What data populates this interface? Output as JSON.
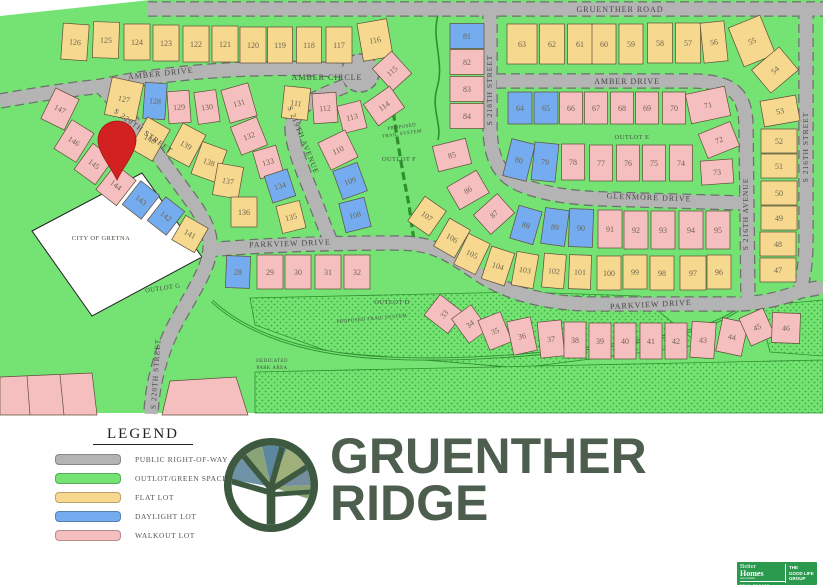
{
  "branding": {
    "title_line1": "GRUENTHER",
    "title_line2": "RIDGE",
    "title_color": "#4d5e4e",
    "logo": "stained-glass-tree-in-circle"
  },
  "bhg_badge": {
    "bg_color": "#2b9a4e",
    "line1": "Better",
    "line2": "Homes",
    "line3": "and Gardens",
    "line4": "REAL ESTATE",
    "right1": "THE",
    "right2": "GOOD LIFE",
    "right3": "GROUP"
  },
  "legend": {
    "title": "LEGEND",
    "items": [
      {
        "label": "PUBLIC RIGHT-OF-WAY",
        "color": "#b4b4b4"
      },
      {
        "label": "OUTLOT/GREEN SPACE",
        "color": "#74e374"
      },
      {
        "label": "FLAT LOT",
        "color": "#f6d98e"
      },
      {
        "label": "DAYLIGHT LOT",
        "color": "#74acef"
      },
      {
        "label": "WALKOUT LOT",
        "color": "#f6bfbf"
      }
    ]
  },
  "map": {
    "colors": {
      "f": "#f6d98e",
      "d": "#74acef",
      "w": "#f6bfbf",
      "road": "#b4b4b4",
      "green": "#74e374",
      "pin": "#d32020"
    },
    "street_labels": [
      {
        "t": "GRUENTHER ROAD",
        "x": 620,
        "y": 12,
        "r": 0,
        "s": 8
      },
      {
        "t": "AMBER DRIVE",
        "x": 161,
        "y": 76,
        "r": -6,
        "s": 8
      },
      {
        "t": "AMBER CIRCLE",
        "x": 327,
        "y": 80,
        "r": 0,
        "s": 8
      },
      {
        "t": "AMBER DRIVE",
        "x": 627,
        "y": 84,
        "r": 0,
        "s": 8
      },
      {
        "t": "S 218TH STREET",
        "x": 492,
        "y": 90,
        "r": -90,
        "s": 7.5
      },
      {
        "t": "S 219TH AVENUE",
        "x": 301,
        "y": 141,
        "r": 68,
        "s": 7.5
      },
      {
        "t": "S 220TH STREET",
        "x": 142,
        "y": 133,
        "r": 36,
        "s": 7.5
      },
      {
        "t": "S 220TH STREET",
        "x": 158,
        "y": 374,
        "r": -86,
        "s": 7.5
      },
      {
        "t": "GLENMORE DRIVE",
        "x": 649,
        "y": 200,
        "r": 2,
        "s": 8
      },
      {
        "t": "PARKVIEW DRIVE",
        "x": 290,
        "y": 246,
        "r": -2,
        "s": 8
      },
      {
        "t": "PARKVIEW DRIVE",
        "x": 651,
        "y": 307,
        "r": -3,
        "s": 8
      },
      {
        "t": "S 216TH AVENUE",
        "x": 748,
        "y": 214,
        "r": -90,
        "s": 7.5
      },
      {
        "t": "S 216TH STREET",
        "x": 808,
        "y": 147,
        "r": -90,
        "s": 7.5
      }
    ],
    "annotations": [
      {
        "t": "CITY OF GRETNA",
        "x": 101,
        "y": 240,
        "r": 0,
        "s": 6.5
      },
      {
        "t": "OUTLOT G",
        "x": 163,
        "y": 290,
        "r": -8,
        "s": 6.5
      },
      {
        "t": "OUTLOT D",
        "x": 392,
        "y": 304,
        "r": 0,
        "s": 6.5
      },
      {
        "t": "OUTLOT E",
        "x": 632,
        "y": 139,
        "r": 0,
        "s": 6.5
      },
      {
        "t": "OUTLOT F",
        "x": 399,
        "y": 161,
        "r": 0,
        "s": 6.5
      },
      {
        "t": "PROPOSED",
        "x": 402,
        "y": 128,
        "r": -8,
        "s": 5
      },
      {
        "t": "TRAIL SYSTEM",
        "x": 402,
        "y": 135,
        "r": -8,
        "s": 5
      },
      {
        "t": "PROPOSED TRAIL SYSTEM",
        "x": 372,
        "y": 320,
        "r": -5,
        "s": 5
      },
      {
        "t": "DEDICATED",
        "x": 272,
        "y": 362,
        "r": 0,
        "s": 5
      },
      {
        "t": "PARK AREA",
        "x": 272,
        "y": 369,
        "r": 0,
        "s": 5
      }
    ],
    "lots": [
      [
        126,
        "f",
        75,
        42,
        26,
        36,
        4
      ],
      [
        125,
        "f",
        106,
        40,
        26,
        36,
        2
      ],
      [
        124,
        "f",
        137,
        42,
        26,
        36,
        0
      ],
      [
        123,
        "f",
        166,
        43,
        26,
        36,
        0
      ],
      [
        122,
        "f",
        196,
        44,
        26,
        36,
        0
      ],
      [
        121,
        "f",
        225,
        44,
        26,
        36,
        0
      ],
      [
        120,
        "f",
        253,
        45,
        26,
        36,
        0
      ],
      [
        119,
        "f",
        280,
        45,
        25,
        36,
        0
      ],
      [
        118,
        "f",
        309,
        45,
        25,
        36,
        0
      ],
      [
        117,
        "f",
        339,
        45,
        26,
        36,
        0
      ],
      [
        116,
        "f",
        375,
        40,
        30,
        38,
        -10
      ],
      [
        115,
        "w",
        392,
        71,
        26,
        30,
        -42
      ],
      [
        114,
        "w",
        384,
        106,
        32,
        26,
        -35
      ],
      [
        113,
        "w",
        352,
        117,
        24,
        28,
        -14
      ],
      [
        112,
        "w",
        325,
        108,
        24,
        30,
        -4
      ],
      [
        111,
        "f",
        296,
        103,
        26,
        32,
        6
      ],
      [
        127,
        "f",
        124,
        99,
        32,
        38,
        12
      ],
      [
        128,
        "d",
        155,
        101,
        22,
        36,
        4
      ],
      [
        129,
        "w",
        179,
        107,
        22,
        32,
        -4
      ],
      [
        130,
        "w",
        207,
        107,
        22,
        32,
        -8
      ],
      [
        131,
        "w",
        239,
        103,
        28,
        34,
        -16
      ],
      [
        132,
        "w",
        249,
        136,
        28,
        30,
        -22
      ],
      [
        133,
        "w",
        268,
        162,
        24,
        28,
        -16
      ],
      [
        134,
        "d",
        280,
        186,
        24,
        28,
        -18
      ],
      [
        135,
        "f",
        291,
        217,
        24,
        28,
        -14
      ],
      [
        110,
        "w",
        338,
        150,
        30,
        30,
        -26
      ],
      [
        109,
        "d",
        350,
        181,
        26,
        30,
        -20
      ],
      [
        108,
        "d",
        355,
        215,
        26,
        30,
        -14
      ],
      [
        147,
        "w",
        60,
        109,
        26,
        34,
        26
      ],
      [
        146,
        "w",
        74,
        141,
        26,
        34,
        32
      ],
      [
        145,
        "w",
        94,
        164,
        26,
        32,
        36
      ],
      [
        144,
        "w",
        116,
        185,
        26,
        32,
        38
      ],
      [
        143,
        "d",
        141,
        200,
        24,
        30,
        38
      ],
      [
        142,
        "d",
        166,
        216,
        24,
        30,
        38
      ],
      [
        141,
        "f",
        190,
        234,
        26,
        28,
        30
      ],
      [
        140,
        "f",
        150,
        139,
        26,
        36,
        30
      ],
      [
        139,
        "f",
        186,
        145,
        26,
        36,
        28
      ],
      [
        138,
        "f",
        209,
        162,
        26,
        34,
        20
      ],
      [
        137,
        "f",
        228,
        181,
        26,
        32,
        10
      ],
      [
        136,
        "f",
        244,
        212,
        26,
        30,
        0
      ],
      [
        28,
        "d",
        238,
        272,
        24,
        32,
        2
      ],
      [
        29,
        "w",
        270,
        272,
        26,
        34,
        0
      ],
      [
        30,
        "w",
        298,
        272,
        26,
        34,
        0
      ],
      [
        31,
        "w",
        328,
        272,
        26,
        34,
        0
      ],
      [
        32,
        "w",
        357,
        272,
        26,
        34,
        0
      ],
      [
        81,
        "d",
        467,
        36,
        34,
        25,
        0
      ],
      [
        82,
        "w",
        467,
        62,
        34,
        25,
        0
      ],
      [
        83,
        "w",
        467,
        89,
        34,
        25,
        0
      ],
      [
        84,
        "w",
        467,
        116,
        34,
        25,
        0
      ],
      [
        85,
        "w",
        452,
        155,
        34,
        26,
        -14
      ],
      [
        86,
        "w",
        468,
        190,
        34,
        26,
        -30
      ],
      [
        87,
        "w",
        494,
        214,
        32,
        26,
        -42
      ],
      [
        63,
        "f",
        522,
        44,
        30,
        40,
        0
      ],
      [
        62,
        "f",
        552,
        44,
        25,
        40,
        0
      ],
      [
        61,
        "f",
        580,
        44,
        25,
        40,
        0
      ],
      [
        60,
        "f",
        604,
        44,
        24,
        40,
        0
      ],
      [
        59,
        "f",
        631,
        44,
        24,
        40,
        0
      ],
      [
        58,
        "f",
        660,
        43,
        25,
        40,
        0
      ],
      [
        57,
        "f",
        688,
        43,
        25,
        40,
        0
      ],
      [
        56,
        "f",
        714,
        42,
        24,
        40,
        -6
      ],
      [
        55,
        "f",
        752,
        41,
        34,
        42,
        -22
      ],
      [
        54,
        "f",
        775,
        70,
        36,
        30,
        -40
      ],
      [
        53,
        "f",
        780,
        111,
        36,
        26,
        -10
      ],
      [
        52,
        "f",
        779,
        141,
        36,
        24,
        0
      ],
      [
        51,
        "f",
        779,
        166,
        36,
        24,
        0
      ],
      [
        50,
        "f",
        779,
        193,
        36,
        24,
        0
      ],
      [
        49,
        "f",
        779,
        218,
        36,
        24,
        0
      ],
      [
        48,
        "f",
        778,
        244,
        36,
        24,
        0
      ],
      [
        47,
        "f",
        778,
        270,
        36,
        24,
        0
      ],
      [
        64,
        "d",
        520,
        108,
        24,
        32,
        0
      ],
      [
        65,
        "d",
        546,
        108,
        24,
        32,
        0
      ],
      [
        66,
        "w",
        571,
        108,
        23,
        32,
        0
      ],
      [
        67,
        "w",
        596,
        108,
        23,
        32,
        0
      ],
      [
        68,
        "w",
        622,
        108,
        23,
        32,
        0
      ],
      [
        69,
        "w",
        647,
        108,
        23,
        32,
        0
      ],
      [
        70,
        "w",
        674,
        108,
        23,
        32,
        0
      ],
      [
        71,
        "w",
        708,
        105,
        40,
        30,
        -12
      ],
      [
        72,
        "w",
        719,
        140,
        34,
        26,
        -22
      ],
      [
        73,
        "w",
        717,
        172,
        32,
        24,
        -4
      ],
      [
        80,
        "d",
        519,
        160,
        24,
        38,
        14
      ],
      [
        79,
        "d",
        545,
        162,
        24,
        38,
        6
      ],
      [
        78,
        "w",
        573,
        162,
        23,
        36,
        0
      ],
      [
        77,
        "w",
        601,
        163,
        23,
        36,
        0
      ],
      [
        76,
        "w",
        628,
        163,
        23,
        36,
        0
      ],
      [
        75,
        "w",
        654,
        163,
        23,
        36,
        0
      ],
      [
        74,
        "w",
        681,
        163,
        23,
        36,
        0
      ],
      [
        88,
        "d",
        526,
        225,
        24,
        34,
        16
      ],
      [
        89,
        "d",
        555,
        227,
        24,
        36,
        8
      ],
      [
        90,
        "d",
        581,
        228,
        24,
        38,
        2
      ],
      [
        91,
        "w",
        610,
        229,
        24,
        38,
        0
      ],
      [
        92,
        "w",
        636,
        230,
        24,
        38,
        0
      ],
      [
        93,
        "w",
        663,
        230,
        24,
        38,
        0
      ],
      [
        94,
        "w",
        691,
        230,
        24,
        38,
        0
      ],
      [
        95,
        "w",
        718,
        230,
        24,
        38,
        0
      ],
      [
        107,
        "f",
        427,
        216,
        26,
        30,
        35
      ],
      [
        106,
        "f",
        452,
        238,
        24,
        32,
        30
      ],
      [
        105,
        "f",
        472,
        254,
        24,
        34,
        26
      ],
      [
        104,
        "f",
        498,
        266,
        24,
        34,
        18
      ],
      [
        103,
        "f",
        525,
        270,
        22,
        34,
        10
      ],
      [
        102,
        "f",
        554,
        271,
        22,
        34,
        5
      ],
      [
        101,
        "f",
        580,
        272,
        22,
        34,
        2
      ],
      [
        100,
        "f",
        609,
        273,
        24,
        34,
        0
      ],
      [
        99,
        "f",
        635,
        272,
        24,
        34,
        0
      ],
      [
        98,
        "f",
        662,
        273,
        24,
        34,
        0
      ],
      [
        97,
        "f",
        693,
        273,
        26,
        34,
        0
      ],
      [
        96,
        "f",
        719,
        272,
        24,
        34,
        0
      ],
      [
        33,
        "w",
        444,
        314,
        26,
        30,
        -52
      ],
      [
        34,
        "w",
        470,
        324,
        24,
        30,
        -36
      ],
      [
        35,
        "w",
        495,
        331,
        24,
        32,
        -22
      ],
      [
        36,
        "w",
        522,
        336,
        24,
        34,
        -12
      ],
      [
        37,
        "w",
        551,
        339,
        24,
        36,
        -6
      ],
      [
        38,
        "w",
        575,
        340,
        22,
        36,
        0
      ],
      [
        39,
        "w",
        600,
        341,
        22,
        36,
        0
      ],
      [
        40,
        "w",
        625,
        341,
        22,
        36,
        0
      ],
      [
        41,
        "w",
        651,
        341,
        22,
        36,
        0
      ],
      [
        42,
        "w",
        676,
        341,
        22,
        36,
        0
      ],
      [
        43,
        "w",
        703,
        340,
        24,
        36,
        4
      ],
      [
        44,
        "w",
        732,
        337,
        26,
        34,
        12
      ],
      [
        45,
        "w",
        757,
        327,
        26,
        30,
        -24
      ],
      [
        46,
        "w",
        786,
        328,
        28,
        30,
        2
      ]
    ]
  }
}
